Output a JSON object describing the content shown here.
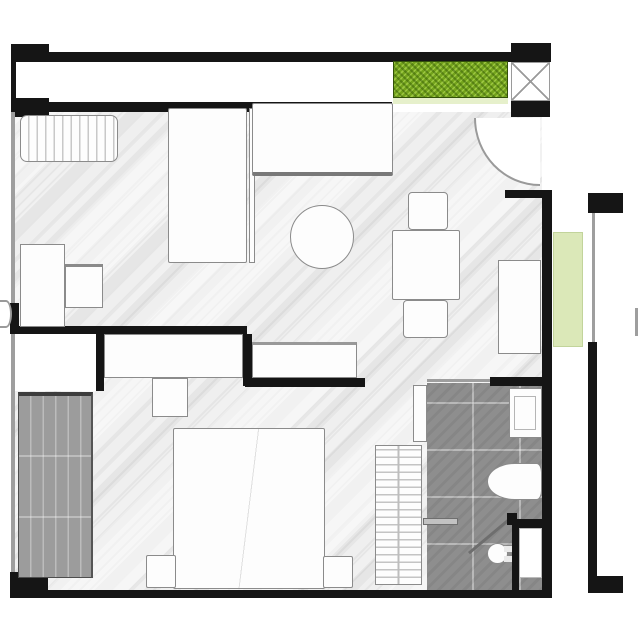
{
  "title": "apartment-floor-plan",
  "legend": {
    "rooms": [
      "balcony",
      "living-dining-area",
      "entrance",
      "bedroom",
      "bathroom",
      "side-terrace"
    ],
    "fixtures": [
      "balcony-planter-box",
      "terrace-planter-box",
      "window-radiator",
      "sofa",
      "wall-cabinet",
      "coffee-table",
      "dining-table",
      "dining-chairs",
      "wall-bench",
      "console",
      "desk",
      "side-table",
      "built-in-closet",
      "tv-unit",
      "wardrobe",
      "double-bed",
      "nightstands",
      "towel-radiator",
      "shower-screen",
      "washbasin",
      "bathtub",
      "toilet",
      "service-shaft",
      "entry-door-swing",
      "bathroom-door"
    ]
  },
  "colors": {
    "wall": "#151515",
    "winline": "#9e9e9e",
    "floorA": "#f1f1f1",
    "floorB": "#e6e6e6",
    "floorC": "#efefef",
    "tile": "#8e8e8e",
    "tileGrid": "rgba(255,255,255,0.38)",
    "wardrobe": "#9c9c9c",
    "wardrobeLine": "rgba(255,255,255,0.32)",
    "furnFill": "#fdfdfd",
    "furnEdge": "#8b8b8b",
    "greenBright": "#73a31c",
    "greenPale": "#dbe8b8",
    "greenSill": "#e6f0cb"
  }
}
